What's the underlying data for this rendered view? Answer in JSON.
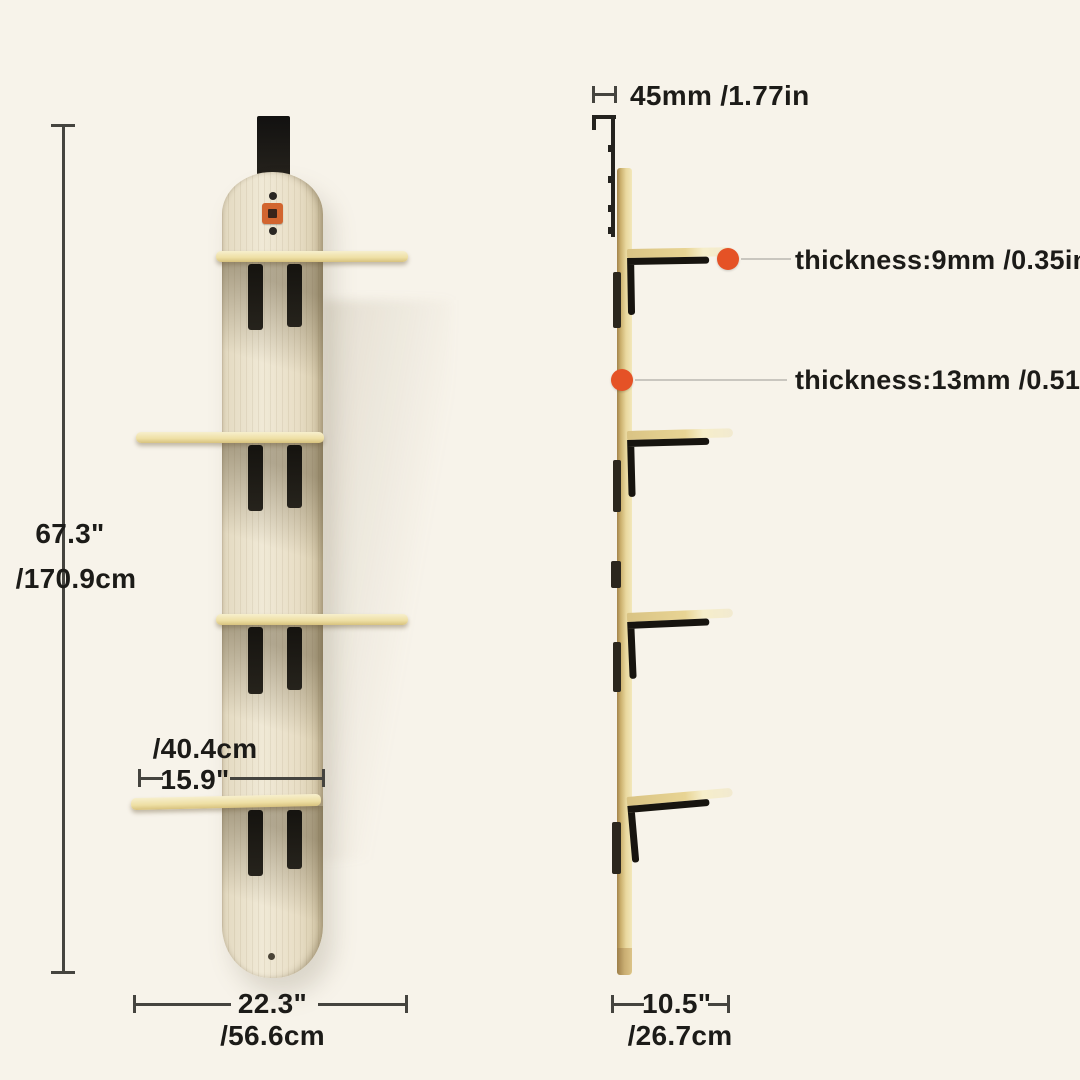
{
  "colors": {
    "background": "#f7f3ea",
    "accent_orange": "#e55226",
    "board_wood": "#ece4d0",
    "shelf_wood": "#eedfa2",
    "bracket_black": "#17140f",
    "dimension_line": "#45443f"
  },
  "front_view": {
    "height_in": "67.3\"",
    "height_cm": "/170.9cm",
    "shelf_width_cm": "/40.4cm",
    "shelf_width_in": "15.9\"",
    "total_width_in": "22.3\"",
    "total_width_cm": "/56.6cm"
  },
  "side_view": {
    "mount_depth": "45mm /1.77in",
    "shelf_thickness": "thickness:9mm /0.35in",
    "board_thickness": "thickness:13mm /0.51in",
    "depth_in": "10.5\"",
    "depth_cm": "/26.7cm"
  }
}
